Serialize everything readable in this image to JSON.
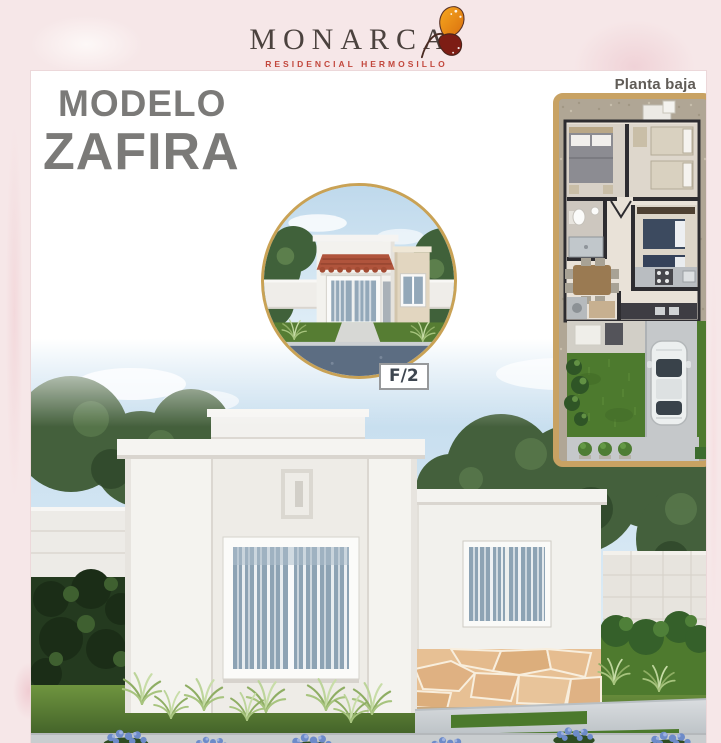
{
  "header": {
    "brand": "MONARCA",
    "tagline": "RESIDENCIAL HERMOSILLO",
    "brand_color": "#4b423e",
    "tagline_color": "#c2473c",
    "butterfly_icon": {
      "upper_wing_color": "#ef8c15",
      "lower_wing_color": "#7d1d14"
    }
  },
  "title": {
    "line1": "MODELO",
    "line2": "ZAFIRA",
    "color": "#7b7a78"
  },
  "exterior_inset": {
    "badge_label": "F/2",
    "ring_color": "#c9a255",
    "badge_text_color": "#3e4650"
  },
  "floor_plan": {
    "label": "Planta baja",
    "label_color": "#605c57",
    "frame_color": "#c8a263"
  },
  "page": {
    "background_pink": "#f6e7e8",
    "panel_border_color": "#ecd8da"
  }
}
